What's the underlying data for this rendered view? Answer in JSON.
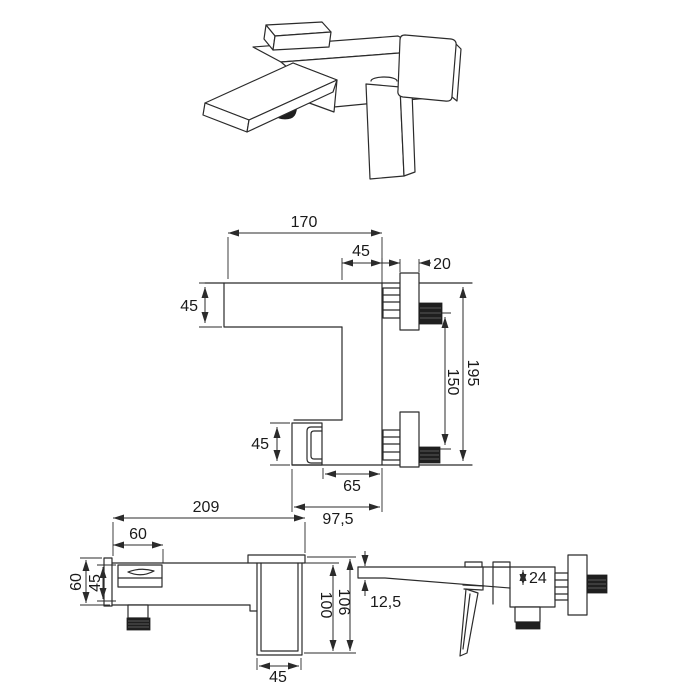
{
  "page": {
    "background": "#ffffff",
    "line_color": "#2b2b2b",
    "dark_fill": "#1f1f1f"
  },
  "views": {
    "front": {
      "dims": {
        "spout_reach": "170",
        "body_width": "45",
        "plate_depth": "20",
        "spout_height": "45",
        "overall_height": "195",
        "pipe_spacing": "150",
        "outlet_height": "45",
        "outlet_inset": "65",
        "outlet_reach": "97,5"
      }
    },
    "top": {
      "dims": {
        "overall_length": "209",
        "spout_length": "60",
        "end_depth": "60",
        "body_depth": "45",
        "handle_depth_outer": "106",
        "handle_depth": "100",
        "handle_width": "45"
      }
    },
    "side": {
      "dims": {
        "spout_tip_height": "12,5",
        "spout_root_height": "24"
      }
    }
  }
}
